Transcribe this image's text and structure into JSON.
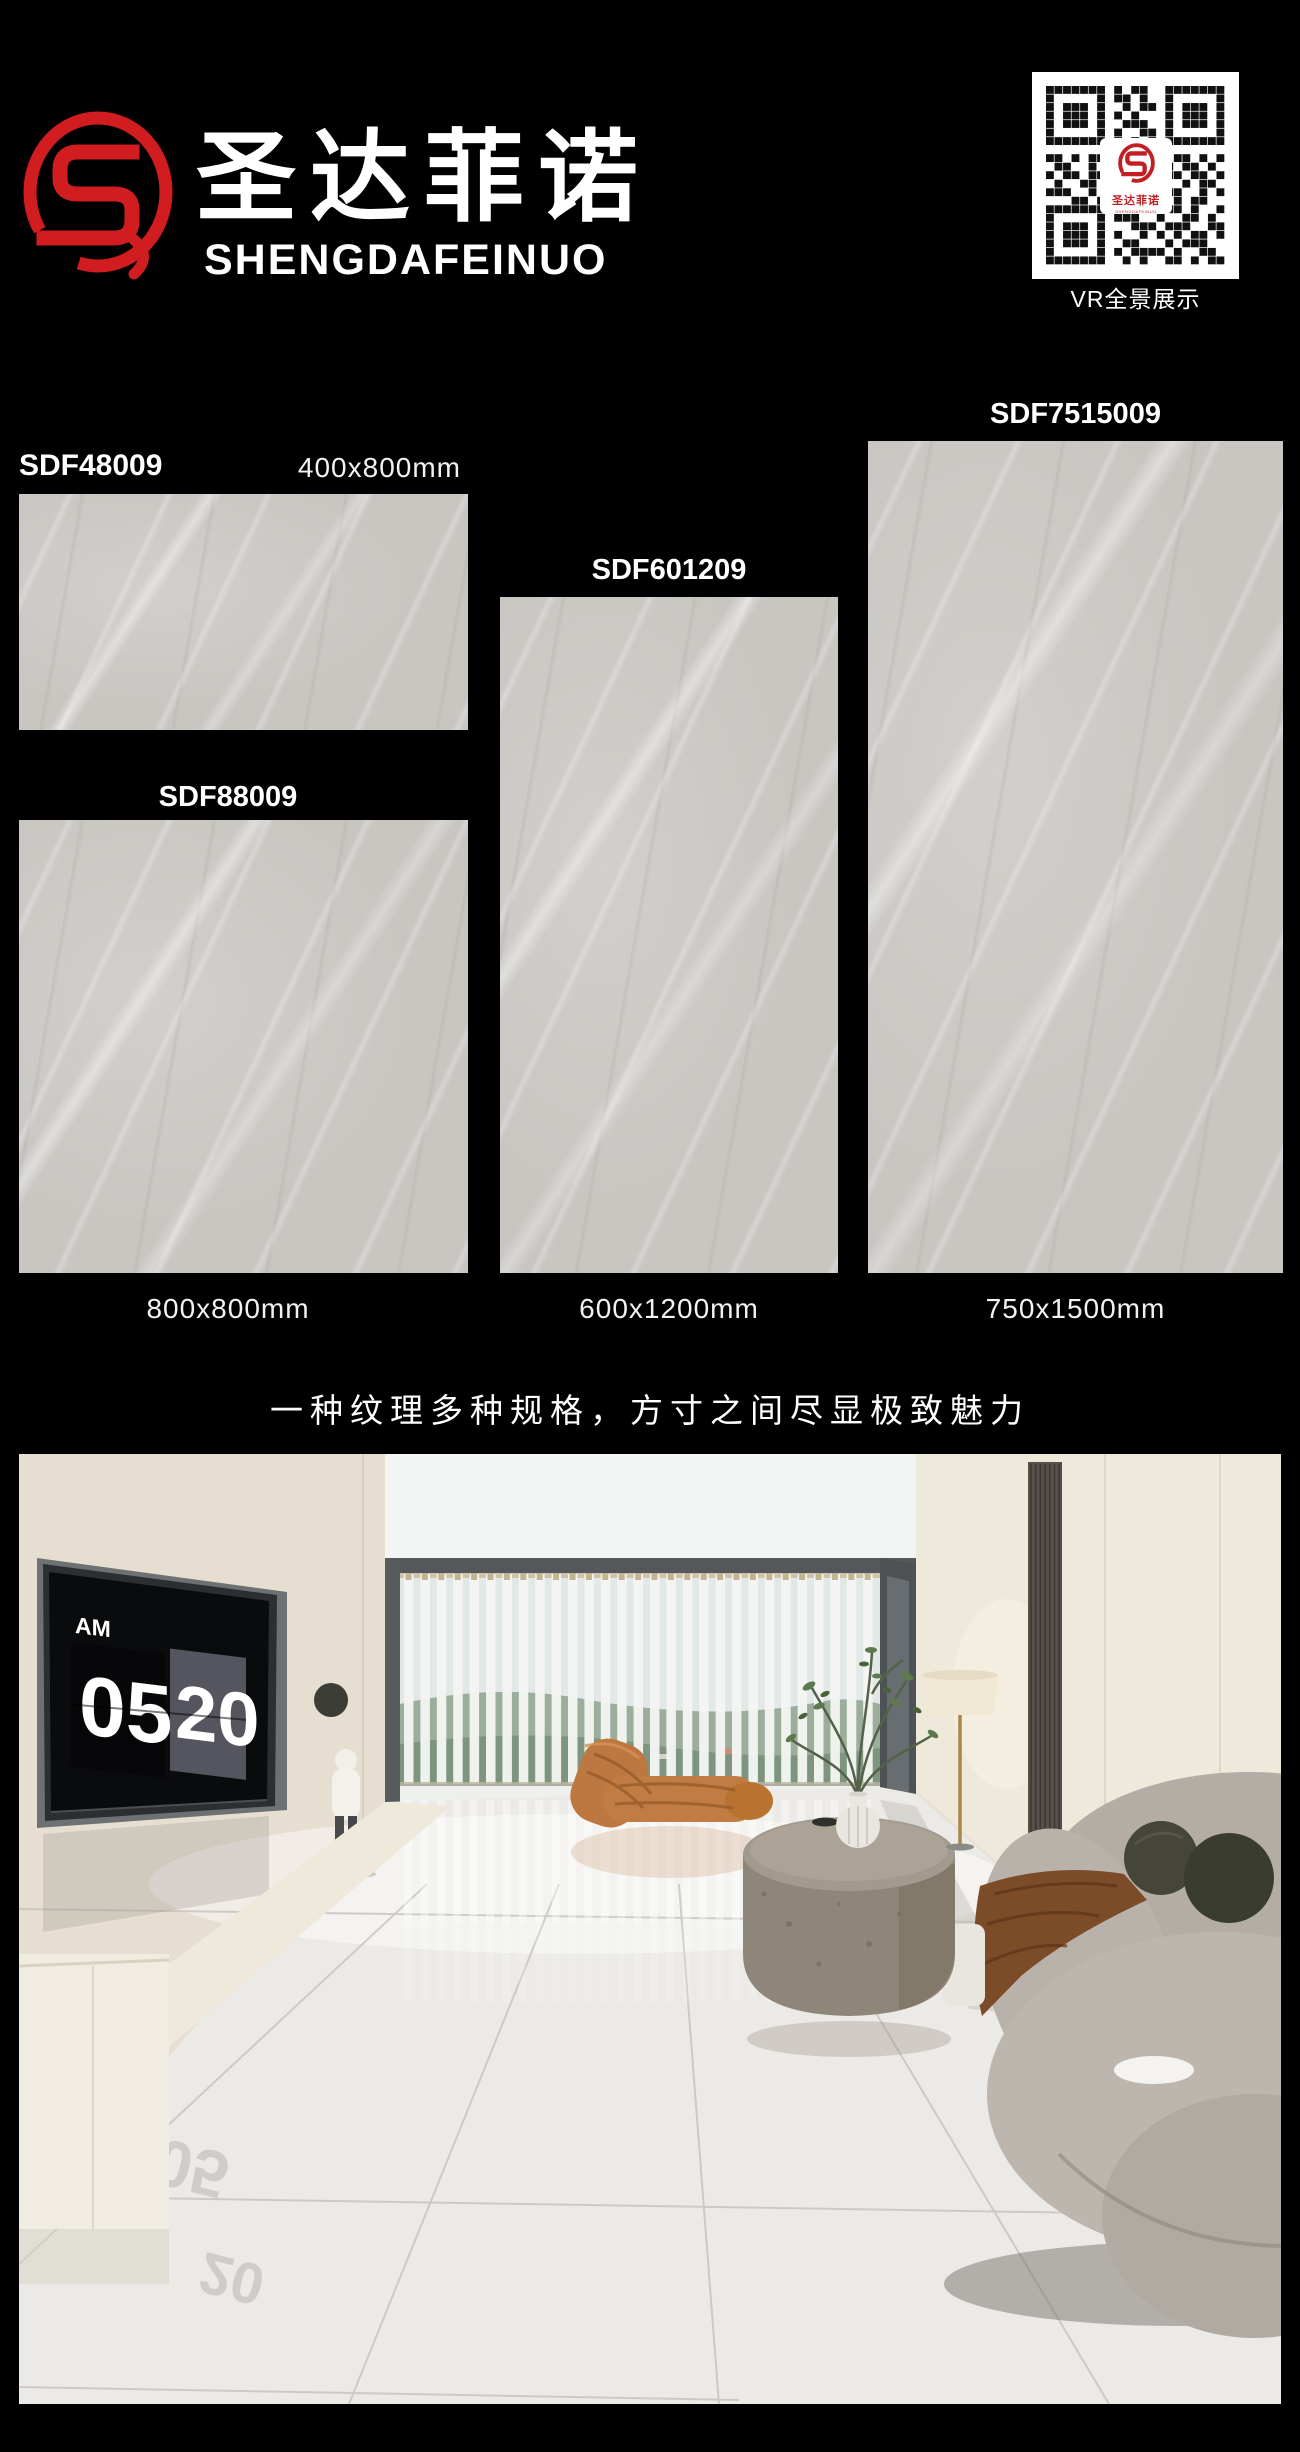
{
  "header": {
    "brand_cn": "圣达菲诺",
    "brand_en": "SHENGDAFEINUO",
    "vr_label": "VR全景展示",
    "qr_center_cn": "圣达菲诺",
    "qr_center_en": "SHENGDAFEINUO"
  },
  "products": [
    {
      "code": "SDF48009",
      "size": "400x800mm"
    },
    {
      "code": "SDF88009",
      "size": "800x800mm"
    },
    {
      "code": "SDF601209",
      "size": "600x1200mm"
    },
    {
      "code": "SDF7515009",
      "size": "750x1500mm"
    }
  ],
  "tagline": "一种纹理多种规格，方寸之间尽显极致魅力",
  "scene": {
    "clock_meridiem": "AM",
    "clock_hour": "05",
    "clock_minute": "20",
    "clock_reflect_hour": "05",
    "clock_reflect_minute": "20"
  },
  "colors": {
    "logo_red": "#d11c20",
    "tile_gray": "#c9c6c2",
    "page_bg": "#000000"
  }
}
